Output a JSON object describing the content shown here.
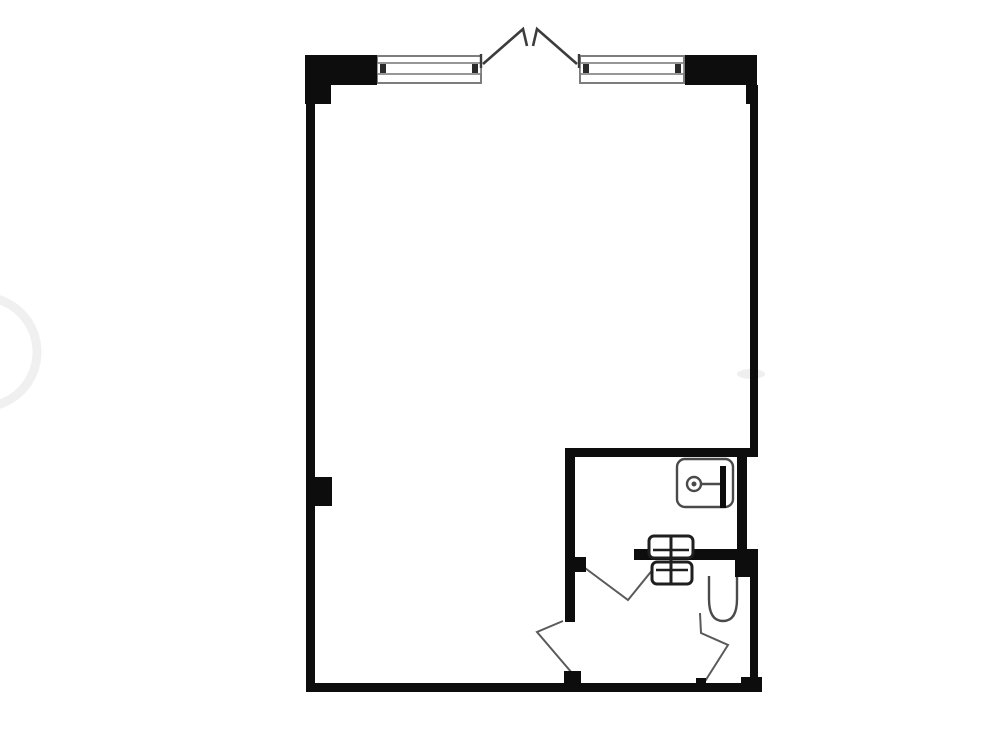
{
  "meta": {
    "type": "floor-plan",
    "description": "Black-and-white architectural floor plan of a studio apartment: one large open room with a window wall and open french doors at top, and a bathroom block (sink room and WC with toilet) in the lower right corner",
    "canvas": {
      "width": 1000,
      "height": 750
    },
    "background": "#ffffff"
  },
  "colors": {
    "wall": "#0d0d0d",
    "window_line": "#7d7d7d",
    "window_tick": "#2b2b2b",
    "door_leaf": "#3c3c3c",
    "swing_line": "#5a5a5a",
    "fixture_line": "#4a4a4a",
    "heater_line": "#1f1f1f",
    "watermark": "#f0f0f0",
    "smudge": "#efefef",
    "white": "#ffffff"
  },
  "plan": {
    "walls": [
      {
        "name": "top-left-pier",
        "x": 305,
        "y": 55,
        "w": 72,
        "h": 30
      },
      {
        "name": "top-left-step",
        "x": 305,
        "y": 85,
        "w": 26,
        "h": 19
      },
      {
        "name": "left-wall",
        "x": 306,
        "y": 85,
        "w": 9,
        "h": 607
      },
      {
        "name": "left-pilaster",
        "x": 306,
        "y": 477,
        "w": 26,
        "h": 29
      },
      {
        "name": "top-right-pier",
        "x": 685,
        "y": 55,
        "w": 72,
        "h": 30
      },
      {
        "name": "top-right-step",
        "x": 746,
        "y": 85,
        "w": 11,
        "h": 19
      },
      {
        "name": "right-wall-upper",
        "x": 750,
        "y": 85,
        "w": 8,
        "h": 372
      },
      {
        "name": "bathroom-top-wall",
        "x": 566,
        "y": 448,
        "w": 192,
        "h": 9
      },
      {
        "name": "bathroom-left-wall",
        "x": 565,
        "y": 448,
        "w": 10,
        "h": 174
      },
      {
        "name": "bathroom-door-jamb",
        "x": 575,
        "y": 557,
        "w": 11,
        "h": 15
      },
      {
        "name": "bathroom-mid-wall",
        "x": 634,
        "y": 549,
        "w": 124,
        "h": 11
      },
      {
        "name": "sink-right-wall",
        "x": 737,
        "y": 457,
        "w": 10,
        "h": 94
      },
      {
        "name": "mid-right-block",
        "x": 735,
        "y": 549,
        "w": 23,
        "h": 28
      },
      {
        "name": "right-wall-lower",
        "x": 750,
        "y": 560,
        "w": 8,
        "h": 132
      },
      {
        "name": "bottom-right-corner",
        "x": 741,
        "y": 677,
        "w": 21,
        "h": 15
      },
      {
        "name": "bottom-wall",
        "x": 306,
        "y": 683,
        "w": 456,
        "h": 9
      },
      {
        "name": "entry-door-jamb",
        "x": 564,
        "y": 671,
        "w": 17,
        "h": 12
      },
      {
        "name": "wc-door-jamb",
        "x": 696,
        "y": 678,
        "w": 10,
        "h": 6
      }
    ],
    "windows": [
      {
        "name": "window-left",
        "frame": {
          "x": 377,
          "y": 56,
          "w": 104,
          "h": 27
        },
        "band": {
          "x": 377,
          "y": 63,
          "w": 104,
          "h": 11
        },
        "ticks": [
          {
            "x": 380,
            "y": 64,
            "w": 6,
            "h": 9
          },
          {
            "x": 472,
            "y": 64,
            "w": 6,
            "h": 9
          }
        ]
      },
      {
        "name": "window-right",
        "frame": {
          "x": 580,
          "y": 56,
          "w": 104,
          "h": 27
        },
        "band": {
          "x": 580,
          "y": 63,
          "w": 104,
          "h": 11
        },
        "ticks": [
          {
            "x": 583,
            "y": 64,
            "w": 6,
            "h": 9
          },
          {
            "x": 675,
            "y": 64,
            "w": 6,
            "h": 9
          }
        ]
      }
    ],
    "french_doors": {
      "name": "open-french-doors",
      "jamb_ticks": [
        {
          "x1": 481,
          "y1": 54,
          "x2": 481,
          "y2": 68
        },
        {
          "x1": 579,
          "y1": 54,
          "x2": 579,
          "y2": 68
        }
      ],
      "leaves": [
        {
          "name": "french-door-leaf-left",
          "points": "483,64 523,29 527,46"
        },
        {
          "name": "french-door-leaf-right",
          "points": "577,64 537,29 533,46"
        }
      ]
    },
    "swing_doors": [
      {
        "name": "bathroom-door-swing",
        "points": "585,568 628,600 654,568"
      },
      {
        "name": "entry-door-swing",
        "points": "563,621 537,632 572,673"
      },
      {
        "name": "wc-door-swing",
        "points": "700,613 701,633 728,645 702,686"
      }
    ],
    "sink": {
      "name": "bathroom-sink",
      "basin": {
        "x": 677,
        "y": 459,
        "w": 56,
        "h": 48,
        "rx": 8
      },
      "faucet_bar": {
        "x": 720,
        "y": 466,
        "w": 6,
        "h": 42
      },
      "stem": {
        "x1": 700,
        "y1": 484,
        "x2": 720,
        "y2": 484
      },
      "drain": {
        "cx": 694,
        "cy": 484,
        "r": 7,
        "dot_r": 2.5
      }
    },
    "heater": {
      "name": "wall-heater",
      "upper": {
        "x": 649,
        "y": 536,
        "w": 44,
        "h": 22,
        "rx": 5,
        "line_y": 550
      },
      "lower": {
        "x": 652,
        "y": 562,
        "w": 40,
        "h": 22,
        "rx": 5,
        "line_y": 570
      },
      "center_line": {
        "x": 671,
        "y1": 536,
        "y2": 584
      }
    },
    "toilet": {
      "name": "toilet",
      "path": "M 709 576 L 709 599 Q 709 621 723 621 Q 737 621 737 599 L 737 576"
    },
    "watermark": {
      "name": "watermark-arc",
      "circle": {
        "cx": -18,
        "cy": 352,
        "r": 55,
        "stroke_w": 9
      },
      "smudge": {
        "cx": 751,
        "cy": 374,
        "rx": 14,
        "ry": 5
      }
    }
  }
}
